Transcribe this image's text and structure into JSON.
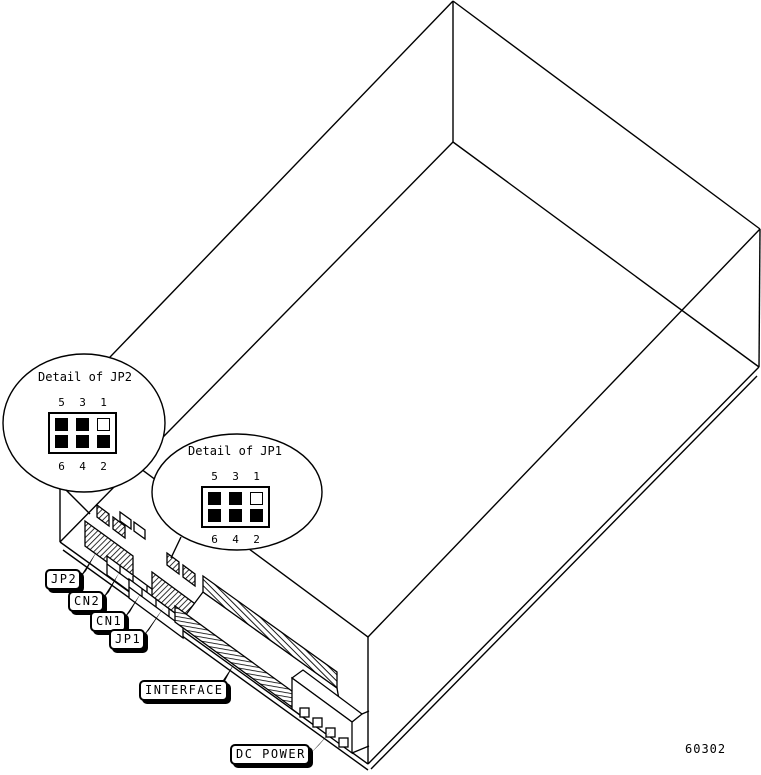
{
  "figure": {
    "type": "hardware-jumper-diagram",
    "part_number": "60302"
  },
  "colors": {
    "ink": "#000000",
    "paper": "#ffffff"
  },
  "details": [
    {
      "title": "Detail of JP2",
      "top_labels": [
        "5",
        "3",
        "1"
      ],
      "bottom_labels": [
        "6",
        "4",
        "2"
      ],
      "pins_top": [
        "pin filled",
        "pin filled",
        "pin open"
      ],
      "pins_bottom": [
        "pin filled",
        "pin filled",
        "pin filled"
      ]
    },
    {
      "title": "Detail of JP1",
      "top_labels": [
        "5",
        "3",
        "1"
      ],
      "bottom_labels": [
        "6",
        "4",
        "2"
      ],
      "pins_top": [
        "pin filled",
        "pin filled",
        "pin open"
      ],
      "pins_bottom": [
        "pin filled",
        "pin filled",
        "pin filled"
      ]
    }
  ],
  "callouts": [
    {
      "label": "JP2"
    },
    {
      "label": "CN2"
    },
    {
      "label": "CN1"
    },
    {
      "label": "JP1"
    },
    {
      "label": "INTERFACE"
    },
    {
      "label": "DC POWER"
    }
  ]
}
